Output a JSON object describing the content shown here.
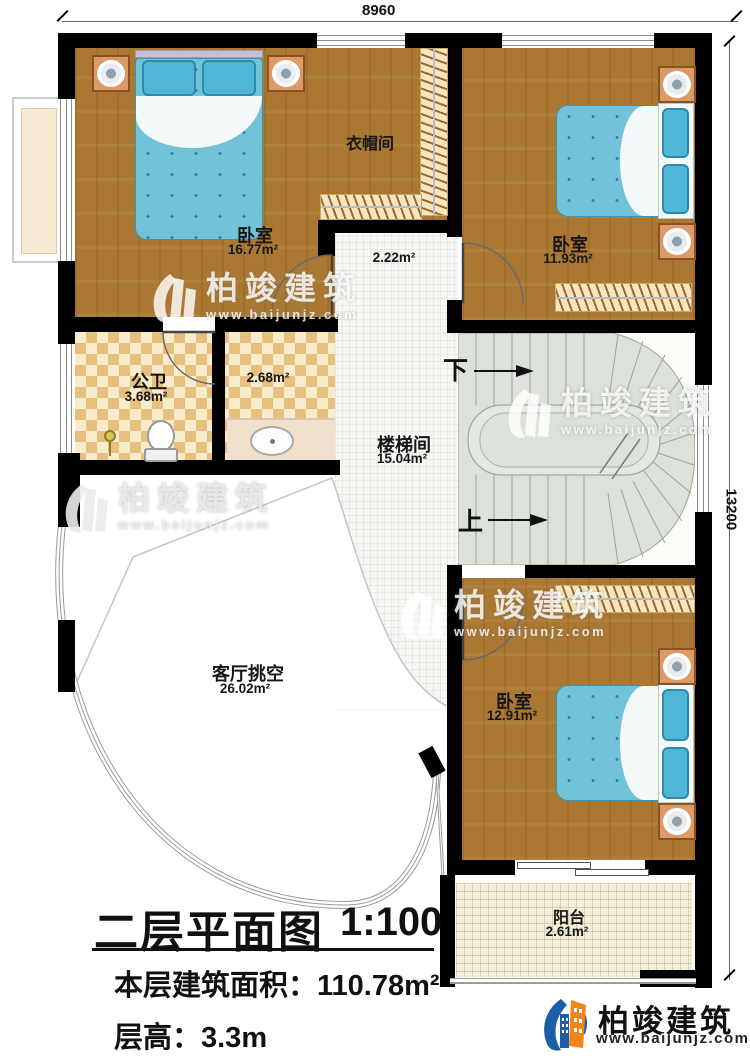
{
  "dimensions": {
    "top": "8960",
    "right": "13200"
  },
  "rooms": {
    "bedroom_tl": {
      "name": "卧室",
      "area": "16.77m²"
    },
    "cloakroom": {
      "name": "衣帽间"
    },
    "hallway": {
      "area": "2.22m²"
    },
    "bedroom_tr": {
      "name": "卧室",
      "area": "11.93m²"
    },
    "bathroom": {
      "name": "公卫",
      "area": "3.68m²"
    },
    "washroom": {
      "area": "2.68m²"
    },
    "stair_hall": {
      "name": "楼梯间",
      "area": "15.04m²"
    },
    "living_void": {
      "name": "客厅挑空",
      "area": "26.02m²"
    },
    "bedroom_br": {
      "name": "卧室",
      "area": "12.91m²"
    },
    "balcony": {
      "name": "阳台",
      "area": "2.61m²"
    }
  },
  "stairs": {
    "down_label": "下",
    "up_label": "上"
  },
  "title_block": {
    "title": "二层平面图",
    "scale": "1:100",
    "floor_area": "本层建筑面积：110.78m²",
    "floor_height": "层高：3.3m"
  },
  "watermark": {
    "brand": "柏竣建筑",
    "url": "www.baijunjz.com"
  },
  "logo": {
    "brand": "柏竣建筑",
    "url": "www.baijunjz.com"
  },
  "colors": {
    "wall": "#000000",
    "wood": "#aa7832",
    "bed_blue": "#72c3da",
    "checker": "#e7bf7e",
    "stair": "#dce2d9",
    "logo_blue": "#1a5fa8",
    "logo_orange": "#f08519"
  }
}
